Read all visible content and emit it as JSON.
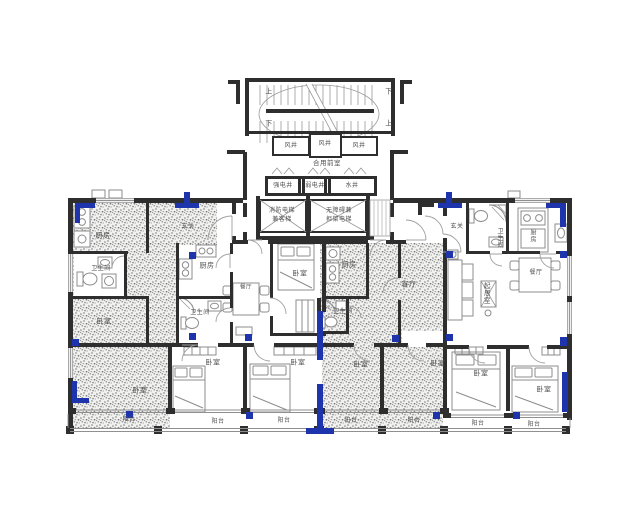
{
  "colors": {
    "wall": "#2e2e2e",
    "accent": "#1e34ad",
    "furn": "#8c8c8c",
    "label": "#4f4f4f",
    "stipbg": "#f1f1f0",
    "stipdot": "#7d7d7d"
  },
  "labels": [
    {
      "t": "上",
      "x": 269,
      "y": 92,
      "n": "stair-up-label"
    },
    {
      "t": "下",
      "x": 389,
      "y": 92,
      "n": "stair-down-label"
    },
    {
      "t": "下",
      "x": 269,
      "y": 124,
      "n": "stair-down-label"
    },
    {
      "t": "上",
      "x": 389,
      "y": 124,
      "n": "stair-up-label"
    },
    {
      "t": "风井",
      "x": 291,
      "y": 146,
      "s": 6,
      "n": "label-wind-shaft-1"
    },
    {
      "t": "风井",
      "x": 325,
      "y": 144,
      "s": 6,
      "n": "label-wind-shaft-2"
    },
    {
      "t": "风井",
      "x": 359,
      "y": 146,
      "s": 6,
      "n": "label-wind-shaft-3"
    },
    {
      "t": "合用前室",
      "x": 327,
      "y": 164,
      "s": 6.5,
      "n": "label-shared-lobby"
    },
    {
      "t": "强电井",
      "x": 283,
      "y": 186,
      "s": 6,
      "n": "label-power-shaft"
    },
    {
      "t": "弱电井",
      "x": 315,
      "y": 186,
      "s": 6,
      "n": "label-telecom-shaft"
    },
    {
      "t": "水井",
      "x": 352,
      "y": 186,
      "s": 6,
      "n": "label-water-shaft"
    },
    {
      "t": "消防电梯",
      "x": 282,
      "y": 211,
      "s": 6,
      "n": "label-fire-elevator"
    },
    {
      "t": "兼客梯",
      "x": 282,
      "y": 220,
      "s": 6,
      "n": "label-fire-elevator-2"
    },
    {
      "t": "无障碍兼",
      "x": 339,
      "y": 211,
      "s": 6,
      "n": "label-accessible-elevator"
    },
    {
      "t": "担架电梯",
      "x": 339,
      "y": 220,
      "s": 6,
      "n": "label-stretcher-elevator"
    },
    {
      "t": "厨房",
      "x": 103,
      "y": 236,
      "n": "label-kitchen-u1"
    },
    {
      "t": "玄关",
      "x": 188,
      "y": 227,
      "s": 6,
      "n": "label-foyer-u1"
    },
    {
      "t": "卫生间",
      "x": 101,
      "y": 269,
      "s": 6,
      "n": "label-bath-u1"
    },
    {
      "t": "卧室",
      "x": 104,
      "y": 322,
      "n": "label-bedroom-u1a"
    },
    {
      "t": "卧室",
      "x": 140,
      "y": 391,
      "n": "label-bedroom-u1b"
    },
    {
      "t": "阳台",
      "x": 129,
      "y": 420,
      "s": 6,
      "n": "label-balcony-u1"
    },
    {
      "t": "厨房",
      "x": 207,
      "y": 266,
      "n": "label-kitchen-u2"
    },
    {
      "t": "卫生间",
      "x": 200,
      "y": 313,
      "s": 6,
      "n": "label-bath-u2"
    },
    {
      "t": "餐厅",
      "x": 246,
      "y": 288,
      "s": 5.5,
      "n": "label-dining-u2"
    },
    {
      "t": "卧室",
      "x": 300,
      "y": 274,
      "n": "label-bedroom-u2a"
    },
    {
      "t": "卧室",
      "x": 213,
      "y": 363,
      "n": "label-bedroom-u2b"
    },
    {
      "t": "阳台",
      "x": 218,
      "y": 422,
      "s": 6,
      "n": "label-balcony-u2b"
    },
    {
      "t": "卧室",
      "x": 298,
      "y": 363,
      "n": "label-bedroom-u2c"
    },
    {
      "t": "阳台",
      "x": 284,
      "y": 421,
      "s": 6,
      "n": "label-balcony-u2c"
    },
    {
      "t": "厨房",
      "x": 349,
      "y": 265,
      "n": "label-kitchen-u3"
    },
    {
      "t": "卫生间",
      "x": 343,
      "y": 312,
      "s": 6,
      "n": "label-bath-u3"
    },
    {
      "t": "客厅",
      "x": 409,
      "y": 285,
      "n": "label-living-u3"
    },
    {
      "t": "卧室",
      "x": 361,
      "y": 365,
      "n": "label-bedroom-u3a"
    },
    {
      "t": "阳台",
      "x": 351,
      "y": 421,
      "s": 6,
      "n": "label-balcony-u3a"
    },
    {
      "t": "卧室",
      "x": 438,
      "y": 364,
      "n": "label-bedroom-u3b"
    },
    {
      "t": "阳台",
      "x": 414,
      "y": 421,
      "s": 6,
      "n": "label-balcony-u3b"
    },
    {
      "t": "玄关",
      "x": 457,
      "y": 227,
      "s": 6,
      "n": "label-foyer-u4"
    },
    {
      "t": "卫生间",
      "x": 499,
      "y": 238,
      "s": 6,
      "v": 1,
      "n": "label-bath-u4"
    },
    {
      "t": "厨房",
      "x": 532,
      "y": 236,
      "s": 6,
      "v": 1,
      "n": "label-kitchen-u4"
    },
    {
      "t": "起居室",
      "x": 485,
      "y": 293,
      "s": 6.5,
      "v": 1,
      "n": "label-living-u4"
    },
    {
      "t": "餐厅",
      "x": 536,
      "y": 273,
      "s": 6,
      "n": "label-dining-u4"
    },
    {
      "t": "卧室",
      "x": 481,
      "y": 374,
      "n": "label-bedroom-u4a"
    },
    {
      "t": "阳台",
      "x": 478,
      "y": 424,
      "s": 6,
      "n": "label-balcony-u4a"
    },
    {
      "t": "卧室",
      "x": 544,
      "y": 390,
      "n": "label-bedroom-u4b"
    },
    {
      "t": "阳台",
      "x": 534,
      "y": 425,
      "s": 6,
      "n": "label-balcony-u4b"
    }
  ]
}
